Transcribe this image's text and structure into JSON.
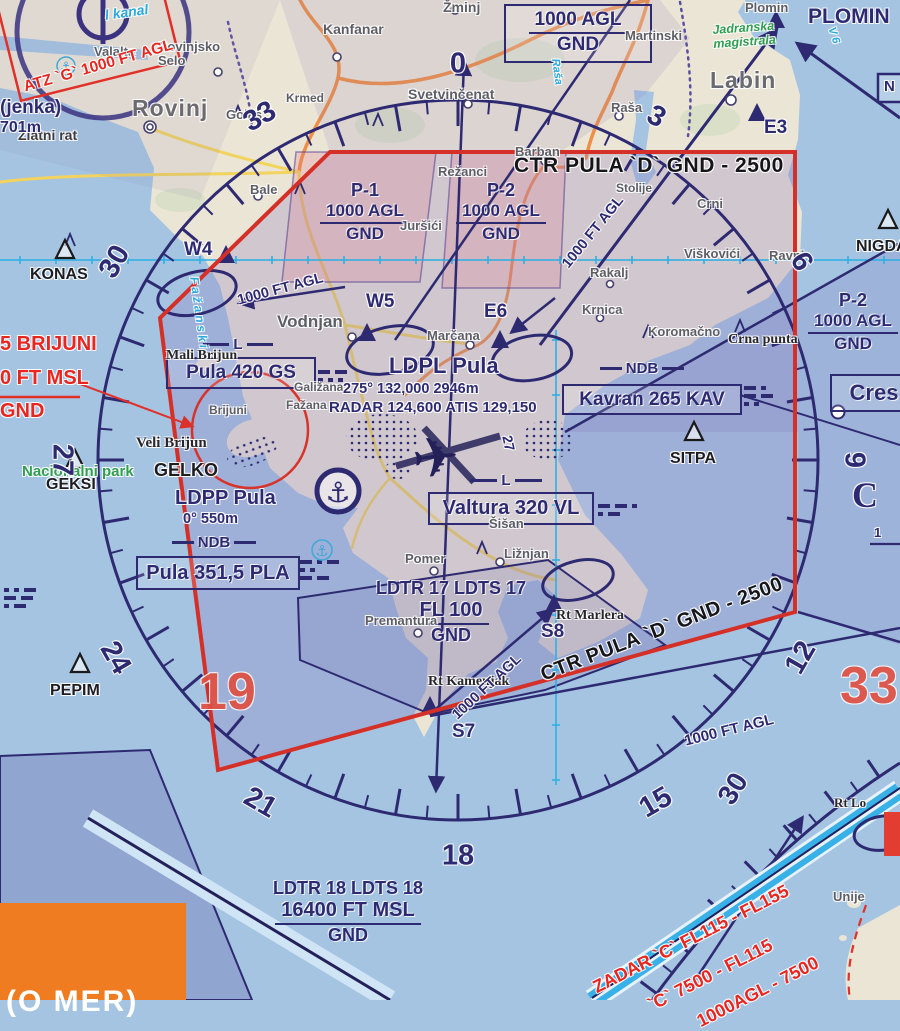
{
  "colors": {
    "sea": "#a5c4e2",
    "land": "#ebe5d5",
    "ctr_border": "#d43028",
    "navy": "#2e2a72",
    "restricted_red": "#e8251f",
    "orange_logo": "#f07c22",
    "cyan_grid": "#28aee4"
  },
  "boxes": {
    "agl_top": {
      "alt": "1000 AGL",
      "floor": "GND"
    },
    "p1": {
      "name": "P-1",
      "alt": "1000 AGL",
      "floor": "GND"
    },
    "p2": {
      "name": "P-2",
      "alt": "1000 AGL",
      "floor": "GND"
    },
    "p2r": {
      "name": "P-2",
      "alt": "1000 AGL",
      "floor": "GND"
    },
    "pula_gs": {
      "marker": "L",
      "text": "Pula 420 GS"
    },
    "kavran": {
      "marker": "NDB",
      "text": "Kavran 265 KAV"
    },
    "valtura": {
      "marker": "L",
      "text": "Valtura 320 VL"
    },
    "pula_ndb": {
      "marker": "NDB",
      "text": "Pula 351,5 PLA"
    },
    "cres": {
      "text": "Cres"
    },
    "ldtr17": {
      "name": "LDTR 17 LDTS 17",
      "alt": "FL 100",
      "floor": "GND"
    },
    "ldtr18": {
      "name": "LDTR 18 LDTS 18",
      "alt": "16400 FT MSL",
      "floor": "GND"
    }
  },
  "compass": {
    "numbers": [
      {
        "t": "0",
        "deg": 0
      },
      {
        "t": "3",
        "deg": 30
      },
      {
        "t": "6",
        "deg": 60
      },
      {
        "t": "9",
        "deg": 90
      },
      {
        "t": "12",
        "deg": 120
      },
      {
        "t": "15",
        "deg": 150
      },
      {
        "t": "18",
        "deg": 180
      },
      {
        "t": "21",
        "deg": 210
      },
      {
        "t": "24",
        "deg": 240
      },
      {
        "t": "27",
        "deg": 270
      },
      {
        "t": "30",
        "deg": 300
      },
      {
        "t": "33",
        "deg": 330
      }
    ]
  },
  "labels": [
    {
      "t": "Valalta",
      "c": "town",
      "s": 13,
      "x": 94,
      "y": 45
    },
    {
      "t": "Rovinjsko\nSelo",
      "c": "town",
      "s": 13,
      "x": 158,
      "y": 40
    },
    {
      "t": "Rovinj",
      "c": "townlg",
      "s": 23,
      "x": 132,
      "y": 96
    },
    {
      "t": "Golaš",
      "c": "town",
      "s": 13,
      "x": 226,
      "y": 108
    },
    {
      "t": "Bale",
      "c": "town",
      "s": 13,
      "x": 250,
      "y": 183
    },
    {
      "t": "Krmed",
      "c": "town",
      "s": 12,
      "x": 286,
      "y": 92
    },
    {
      "t": "Kanfanar",
      "c": "town",
      "s": 14,
      "x": 323,
      "y": 22
    },
    {
      "t": "Žminj",
      "c": "town",
      "s": 14,
      "x": 443,
      "y": 0
    },
    {
      "t": "Svetvinčenat",
      "c": "town",
      "s": 14,
      "x": 408,
      "y": 87
    },
    {
      "t": "Režanci",
      "c": "town",
      "s": 13,
      "x": 438,
      "y": 165
    },
    {
      "t": "Juršići",
      "c": "town",
      "s": 13,
      "x": 400,
      "y": 219
    },
    {
      "t": "Barban",
      "c": "town",
      "s": 13,
      "x": 515,
      "y": 145
    },
    {
      "t": "Stolije",
      "c": "town",
      "s": 12,
      "x": 616,
      "y": 182
    },
    {
      "t": "Martinski",
      "c": "town",
      "s": 13,
      "x": 625,
      "y": 29
    },
    {
      "t": "Plomin",
      "c": "town",
      "s": 13,
      "x": 745,
      "y": 1
    },
    {
      "t": "Labin",
      "c": "townlg",
      "s": 23,
      "x": 710,
      "y": 68
    },
    {
      "t": "Raša",
      "c": "town",
      "s": 13,
      "x": 611,
      "y": 101
    },
    {
      "t": "Rakalj",
      "c": "town",
      "s": 13,
      "x": 590,
      "y": 266
    },
    {
      "t": "Viškovići",
      "c": "town",
      "s": 13,
      "x": 684,
      "y": 247
    },
    {
      "t": "Ravni",
      "c": "town",
      "s": 13,
      "x": 769,
      "y": 249
    },
    {
      "t": "Crni",
      "c": "town",
      "s": 13,
      "x": 697,
      "y": 197
    },
    {
      "t": "Krnica",
      "c": "town",
      "s": 13,
      "x": 582,
      "y": 303
    },
    {
      "t": "Koromačno",
      "c": "town",
      "s": 13,
      "x": 648,
      "y": 325
    },
    {
      "t": "Vodnjan",
      "c": "townmd",
      "s": 17,
      "x": 277,
      "y": 313
    },
    {
      "t": "Marčana",
      "c": "town",
      "s": 13,
      "x": 427,
      "y": 329
    },
    {
      "t": "Galižana",
      "c": "town",
      "s": 12,
      "x": 294,
      "y": 381
    },
    {
      "t": "Fažana",
      "c": "town",
      "s": 12,
      "x": 286,
      "y": 399
    },
    {
      "t": "Šišan",
      "c": "town",
      "s": 13,
      "x": 489,
      "y": 517
    },
    {
      "t": "Ližnjan",
      "c": "town",
      "s": 13,
      "x": 504,
      "y": 547
    },
    {
      "t": "Pomer",
      "c": "town",
      "s": 13,
      "x": 405,
      "y": 552
    },
    {
      "t": "Premantura",
      "c": "town",
      "s": 13,
      "x": 365,
      "y": 614
    },
    {
      "t": "Brijuni",
      "c": "town",
      "s": 12,
      "x": 209,
      "y": 404
    },
    {
      "t": "Unije",
      "c": "town",
      "s": 13,
      "x": 833,
      "y": 890
    },
    {
      "t": "Mali Brijun",
      "c": "geo",
      "s": 14,
      "x": 166,
      "y": 348
    },
    {
      "t": "Veli Brijun",
      "c": "geo",
      "s": 15,
      "x": 136,
      "y": 435
    },
    {
      "t": "Crna punta",
      "c": "geo",
      "s": 14,
      "x": 728,
      "y": 332
    },
    {
      "t": "Rt Marlera",
      "c": "geo",
      "s": 14,
      "x": 556,
      "y": 608
    },
    {
      "t": "Rt Kamenjak",
      "c": "geo",
      "s": 14,
      "x": 428,
      "y": 674
    },
    {
      "t": "Rt Lo",
      "c": "geo",
      "s": 13,
      "x": 834,
      "y": 796
    },
    {
      "t": "Zlatni rat",
      "c": "geos",
      "s": 14,
      "x": 18,
      "y": 128
    },
    {
      "t": "(jenka)",
      "c": "nav",
      "s": 19,
      "x": 0,
      "y": 98
    },
    {
      "t": "701m",
      "c": "nav",
      "s": 16,
      "x": 0,
      "y": 119
    },
    {
      "t": "W4",
      "c": "nav",
      "s": 19,
      "x": 184,
      "y": 240
    },
    {
      "t": "W5",
      "c": "nav",
      "s": 19,
      "x": 366,
      "y": 292
    },
    {
      "t": "E6",
      "c": "nav",
      "s": 19,
      "x": 484,
      "y": 302
    },
    {
      "t": "E3",
      "c": "nav",
      "s": 19,
      "x": 764,
      "y": 118
    },
    {
      "t": "S7",
      "c": "nav",
      "s": 19,
      "x": 452,
      "y": 722
    },
    {
      "t": "S8",
      "c": "nav",
      "s": 19,
      "x": 541,
      "y": 622
    },
    {
      "t": "PLOMIN",
      "c": "nav",
      "s": 21,
      "x": 808,
      "y": 6
    },
    {
      "t": "GELKO",
      "c": "blk",
      "s": 18,
      "x": 154,
      "y": 461
    },
    {
      "t": "KONAS",
      "c": "blk",
      "s": 16,
      "x": 30,
      "y": 266
    },
    {
      "t": "GEKSI",
      "c": "blk",
      "s": 16,
      "x": 46,
      "y": 476
    },
    {
      "t": "PEPIM",
      "c": "blk",
      "s": 16,
      "x": 50,
      "y": 682
    },
    {
      "t": "SITPA",
      "c": "blk",
      "s": 16,
      "x": 670,
      "y": 450
    },
    {
      "t": "NIGDA",
      "c": "blk",
      "s": 16,
      "x": 856,
      "y": 238
    },
    {
      "t": "N",
      "c": "nav",
      "s": 15,
      "x": 884,
      "y": 79
    },
    {
      "t": "C",
      "c": "bigc",
      "s": 36,
      "x": 852,
      "y": 476
    },
    {
      "t": "1",
      "c": "nav",
      "s": 13,
      "x": 874,
      "y": 526
    },
    {
      "t": "27",
      "c": "nav",
      "s": 14,
      "x": 514,
      "y": 434,
      "r": 78
    },
    {
      "t": "LDPL Pula",
      "c": "nav",
      "s": 22,
      "x": 389,
      "y": 354
    },
    {
      "t": "275°  132,000  2946m",
      "c": "nav",
      "s": 14.5,
      "x": 343,
      "y": 382
    },
    {
      "t": "RADAR 124,600 ATIS 129,150",
      "c": "nav",
      "s": 15,
      "x": 329,
      "y": 400
    },
    {
      "t": "LDPP Pula",
      "c": "nav",
      "s": 20,
      "x": 175,
      "y": 488
    },
    {
      "t": "0°      550m",
      "c": "nav",
      "s": 14.5,
      "x": 183,
      "y": 512
    },
    {
      "t": "Jadranska\nmagistrala",
      "c": "green",
      "s": 12.5,
      "x": 712,
      "y": 24,
      "r": -4
    },
    {
      "t": "Nacionalni park",
      "c": "green2",
      "s": 15,
      "x": 22,
      "y": 464
    },
    {
      "t": "l kanal",
      "c": "cyan",
      "s": 14,
      "x": 104,
      "y": 8,
      "r": -8
    },
    {
      "t": "Fažanski",
      "c": "cyan",
      "s": 12,
      "x": 200,
      "y": 276,
      "r": 82,
      "ls": 3
    },
    {
      "t": "Raša",
      "c": "cyan",
      "s": 11,
      "x": 560,
      "y": 58,
      "r": 82
    },
    {
      "t": "V 6",
      "c": "cyan",
      "s": 11,
      "x": 836,
      "y": 26,
      "r": 72
    },
    {
      "t": "5 BRIJUNI",
      "c": "redb",
      "s": 20,
      "x": 0,
      "y": 334
    },
    {
      "t": "0 FT MSL",
      "c": "redb",
      "s": 20,
      "x": 0,
      "y": 368
    },
    {
      "t": "GND",
      "c": "redb",
      "s": 20,
      "x": 0,
      "y": 401
    },
    {
      "t": "ATZ `G` 1000 FT AGL",
      "c": "redb",
      "s": 15.5,
      "x": 22,
      "y": 80,
      "r": -16
    },
    {
      "t": "ZADAR `C` FL115 - FL155",
      "c": "redb",
      "s": 18,
      "x": 590,
      "y": 980,
      "r": -27
    },
    {
      "t": "`C` 7500 - FL115",
      "c": "redb",
      "s": 18,
      "x": 645,
      "y": 998,
      "r": -27
    },
    {
      "t": "1000AGL - 7500",
      "c": "redb",
      "s": 18,
      "x": 694,
      "y": 1014,
      "r": -27
    },
    {
      "t": "1000 FT AGL",
      "c": "nav",
      "s": 14.5,
      "x": 236,
      "y": 294,
      "r": -15
    },
    {
      "t": "1000 FT AGL",
      "c": "nav",
      "s": 14.5,
      "x": 560,
      "y": 262,
      "r": -51
    },
    {
      "t": "1000 FT AGL",
      "c": "nav",
      "s": 14.5,
      "x": 450,
      "y": 712,
      "r": -43
    },
    {
      "t": "1000 FT AGL",
      "c": "nav",
      "s": 15,
      "x": 683,
      "y": 734,
      "r": -14
    },
    {
      "t": "CTR PULA `D`  GND - 2500",
      "c": "blkb",
      "s": 21,
      "x": 514,
      "y": 155
    },
    {
      "t": "CTR PULA `D` GND - 2500",
      "c": "blkb",
      "s": 20,
      "x": 538,
      "y": 666,
      "r": -21
    },
    {
      "t": "19",
      "c": "bigred",
      "s": 52,
      "x": 198,
      "y": 664
    },
    {
      "t": "33",
      "c": "bigred",
      "s": 52,
      "x": 840,
      "y": 658
    },
    {
      "t": "30",
      "c": "rosen",
      "s": 28,
      "x": 712,
      "y": 794,
      "r": -58
    },
    {
      "t": "(O MER)",
      "c": "logo",
      "s": 30,
      "x": 6,
      "y": 986
    }
  ]
}
